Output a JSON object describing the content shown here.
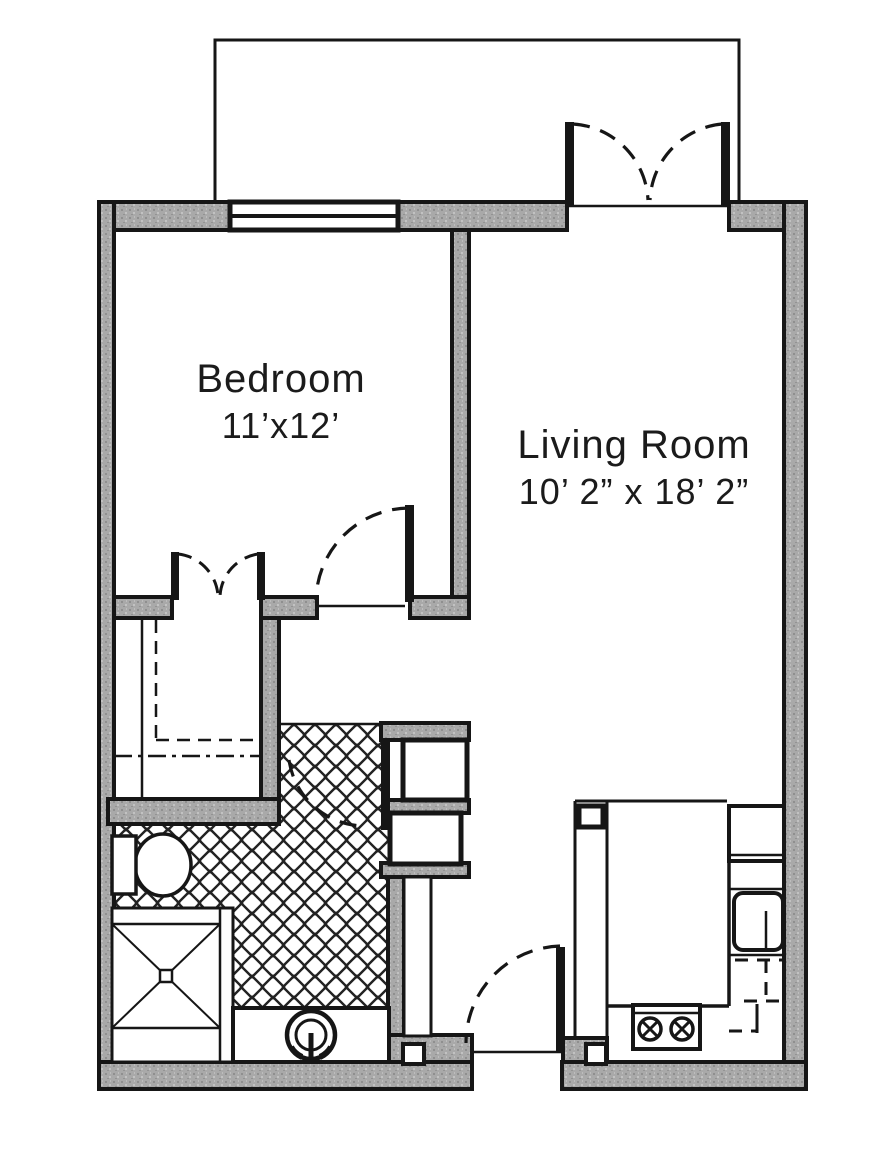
{
  "rooms": {
    "bedroom": {
      "label": "Bedroom",
      "dimensions": "11’x12’"
    },
    "living_room": {
      "label": "Living Room",
      "dimensions": "10’ 2” x 18’ 2”"
    }
  },
  "features": {
    "balcony": "balcony",
    "balcony_doors": "double-french-doors",
    "bedroom_window": "window",
    "closet_doors": "double-closet-doors",
    "bedroom_door": "swing-door",
    "bathroom_door": "swing-door",
    "entry_door": "swing-door",
    "toilet": "toilet",
    "shower": "shower-stall-with-drain",
    "vanity_sink": "round-vanity-sink",
    "kitchen_sink": "kitchen-sink",
    "refrigerator": "refrigerator",
    "range": "two-burner-range",
    "floor_finish": "tile-cross-hatch"
  },
  "colors": {
    "wall_fill": "#a9a9a9",
    "line": "#161616",
    "background": "#ffffff"
  }
}
